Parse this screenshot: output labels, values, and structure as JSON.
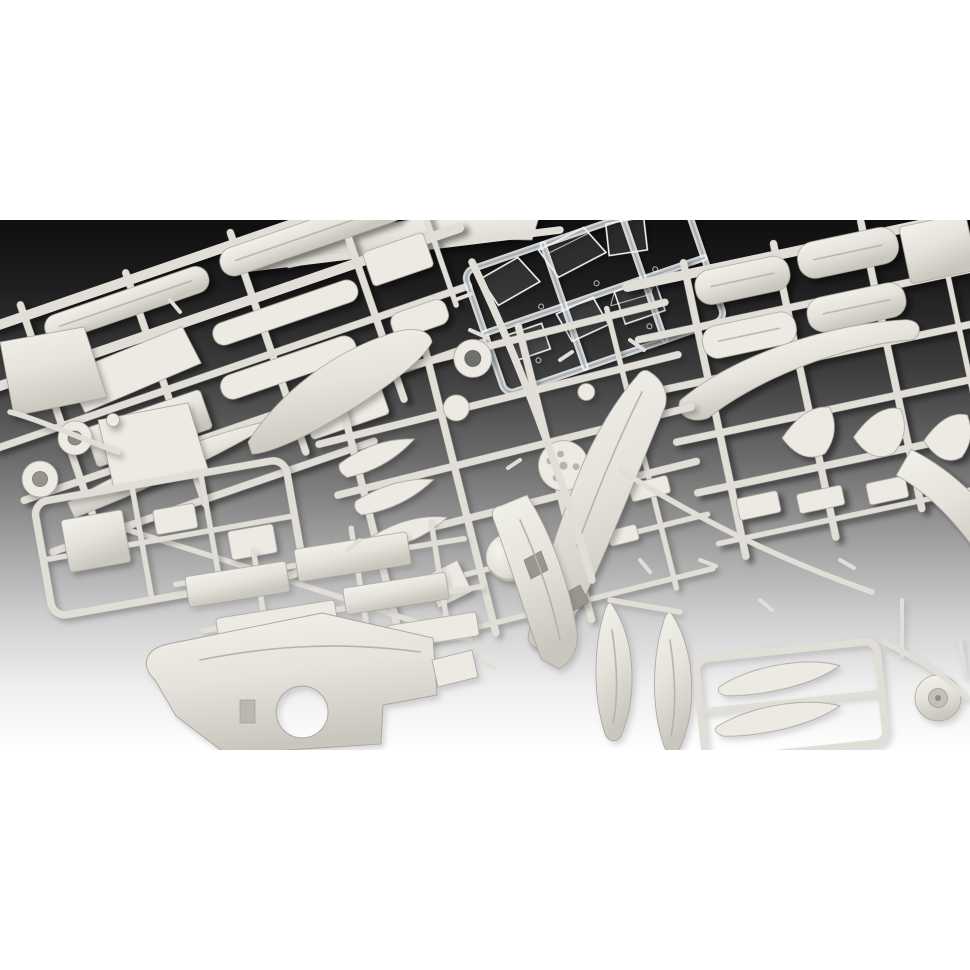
{
  "page": {
    "background": "#ffffff",
    "photo_top_px": 220,
    "photo_height_px": 530
  },
  "photo": {
    "alt": "Overhead studio photograph of an unassembled plastic scale-model aircraft kit: several light grey injection-moulded sprues densely packed with parts (fuselage halves, wings, cowling halves, propeller blades, spinner, wheels, drop tanks, fins and small fittings) and one transparent sprue with clear canopy parts, laid on a background that fades from near-black at the top to white at the bottom.",
    "colors": {
      "page_bg": "#ffffff",
      "bg_top": "#0f0f0f",
      "bg_upper": "#2e2e2e",
      "bg_mid": "#6b6b6b",
      "bg_lower": "#cfcfcf",
      "bg_bottom": "#ffffff",
      "plastic_light": "#eceae3",
      "plastic_mid": "#e0ded6",
      "plastic_shade": "#b5b3aa",
      "plastic_edge": "#a8a69d",
      "clear_edge": "#f2f5f7"
    },
    "objects": [
      {
        "name": "sprue-top-left",
        "description": "grey sprue with long fuselage strips, wing panels and an oval part"
      },
      {
        "name": "panels-left",
        "description": "two large square wing panels at the left edge"
      },
      {
        "name": "wheels-left",
        "description": "two ring-shaped main-wheel tyres and a small disc"
      },
      {
        "name": "clear-parts-sprue",
        "description": "transparent sprue with windscreen and canopy parts"
      },
      {
        "name": "sprue-right",
        "description": "grey sprue with four engine cowling halves, a smooth wing, three curved fins and a tail tube"
      },
      {
        "name": "sprue-center",
        "description": "grey sprue with propeller blades, discs, spinner dome, hub and a large fuselage half"
      },
      {
        "name": "big-smooth-blade",
        "description": "large smooth tapered wing/blade piece"
      },
      {
        "name": "sprue-bottom-left",
        "description": "small framed sprue with square panel parts"
      },
      {
        "name": "flat-panels",
        "description": "rows of flat rectangular panel parts"
      },
      {
        "name": "big-lower-wing",
        "description": "one-piece lower wing with round wheel-well cutout"
      },
      {
        "name": "fuselage-half-bottom",
        "description": "fuselage half with open cockpit interior"
      },
      {
        "name": "drop-tanks",
        "description": "two teardrop-shaped external fuel tanks"
      },
      {
        "name": "propeller-frame",
        "description": "framed pair of long propeller blades"
      },
      {
        "name": "wheel-right",
        "description": "wheel hub disc at lower right"
      }
    ]
  }
}
